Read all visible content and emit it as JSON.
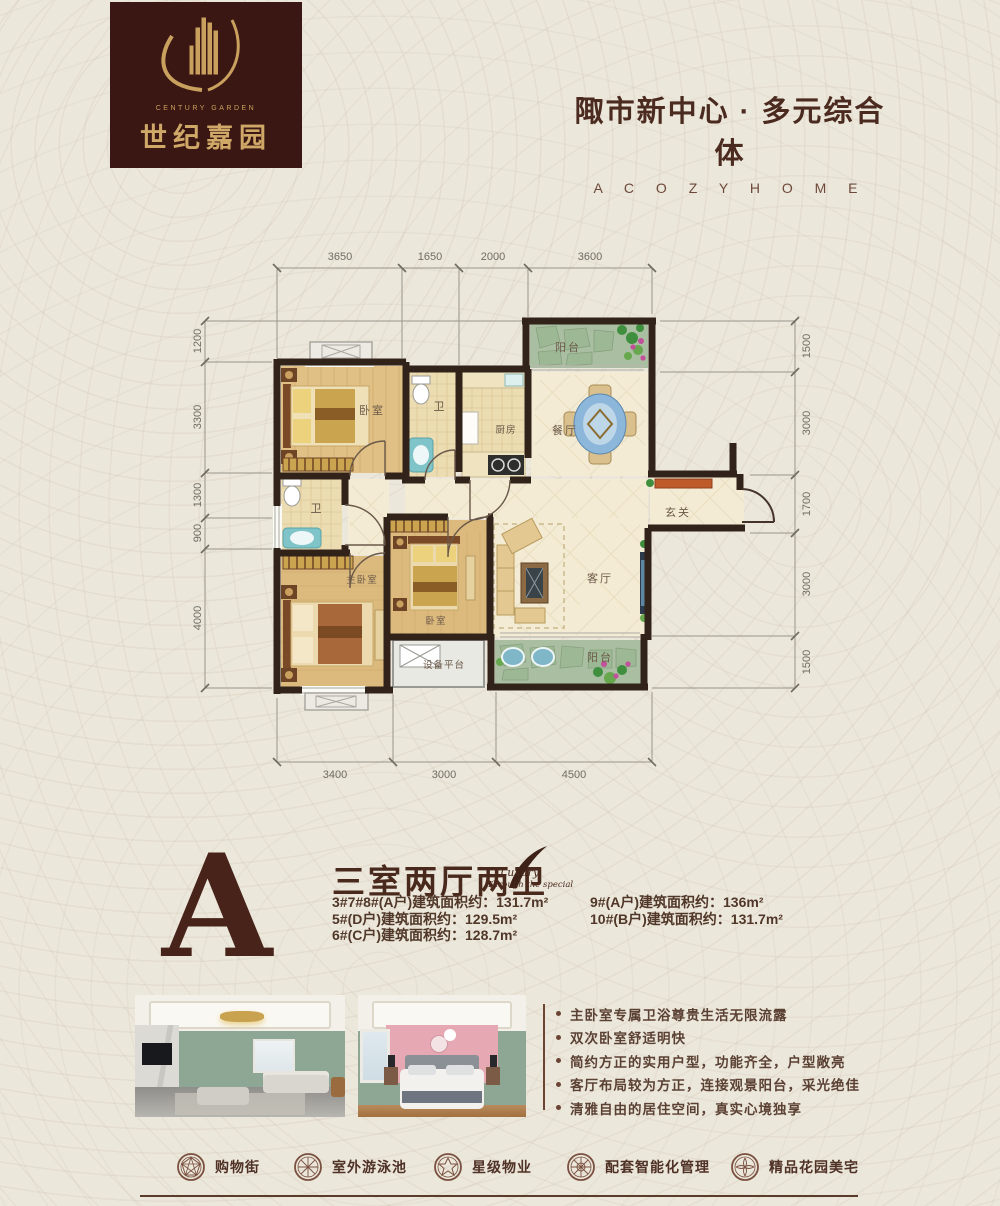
{
  "brand": {
    "name_cn": "世纪嘉园",
    "name_en": "CENTURY GARDEN"
  },
  "slogan": {
    "cn": "陬市新中心 · 多元综合体",
    "en": "A C O Z Y H O M E"
  },
  "plan": {
    "dims_top": [
      "3650",
      "1650",
      "2000",
      "3600"
    ],
    "dims_bottom": [
      "3400",
      "3000",
      "4500"
    ],
    "dims_left": [
      "1200",
      "3300",
      "1300",
      "900",
      "4000"
    ],
    "dims_right": [
      "1500",
      "3000",
      "1700",
      "3000",
      "1500"
    ],
    "rooms": {
      "bedroom1": "卧室",
      "bath1": "卫",
      "kitchen": "厨房",
      "dining": "餐厅",
      "balcony_top": "阳台",
      "entry": "玄关",
      "living": "客厅",
      "bath2": "卫",
      "master": "主卧室",
      "bedroom2": "卧室",
      "equipment": "设备平台",
      "balcony_bottom": "阳台"
    }
  },
  "unit": {
    "letter": "A",
    "layout_title": "三室两厅两卫",
    "script_line1": "Luxury",
    "script_line2": "Through the special",
    "specs_left": [
      "3#7#8#(A户)建筑面积约：131.7m²",
      "5#(D户)建筑面积约：129.5m²",
      "6#(C户)建筑面积约：128.7m²"
    ],
    "specs_right": [
      "9#(A户)建筑面积约：136m²",
      "10#(B户)建筑面积约：131.7m²"
    ]
  },
  "features": [
    "主卧室专属卫浴尊贵生活无限流露",
    "双次卧室舒适明快",
    "简约方正的实用户型，功能齐全，户型敞亮",
    "客厅布局较为方正，连接观景阳台，采光绝佳",
    "清雅自由的居住空间，真实心境独享"
  ],
  "amenities": [
    "购物街",
    "室外游泳池",
    "星级物业",
    "配套智能化管理",
    "精品花园美宅"
  ],
  "colors": {
    "accent": "#4a291d",
    "wall": "#32231a",
    "gold": "#c9a05e",
    "cabinet_orange": "#bf5b2a"
  }
}
